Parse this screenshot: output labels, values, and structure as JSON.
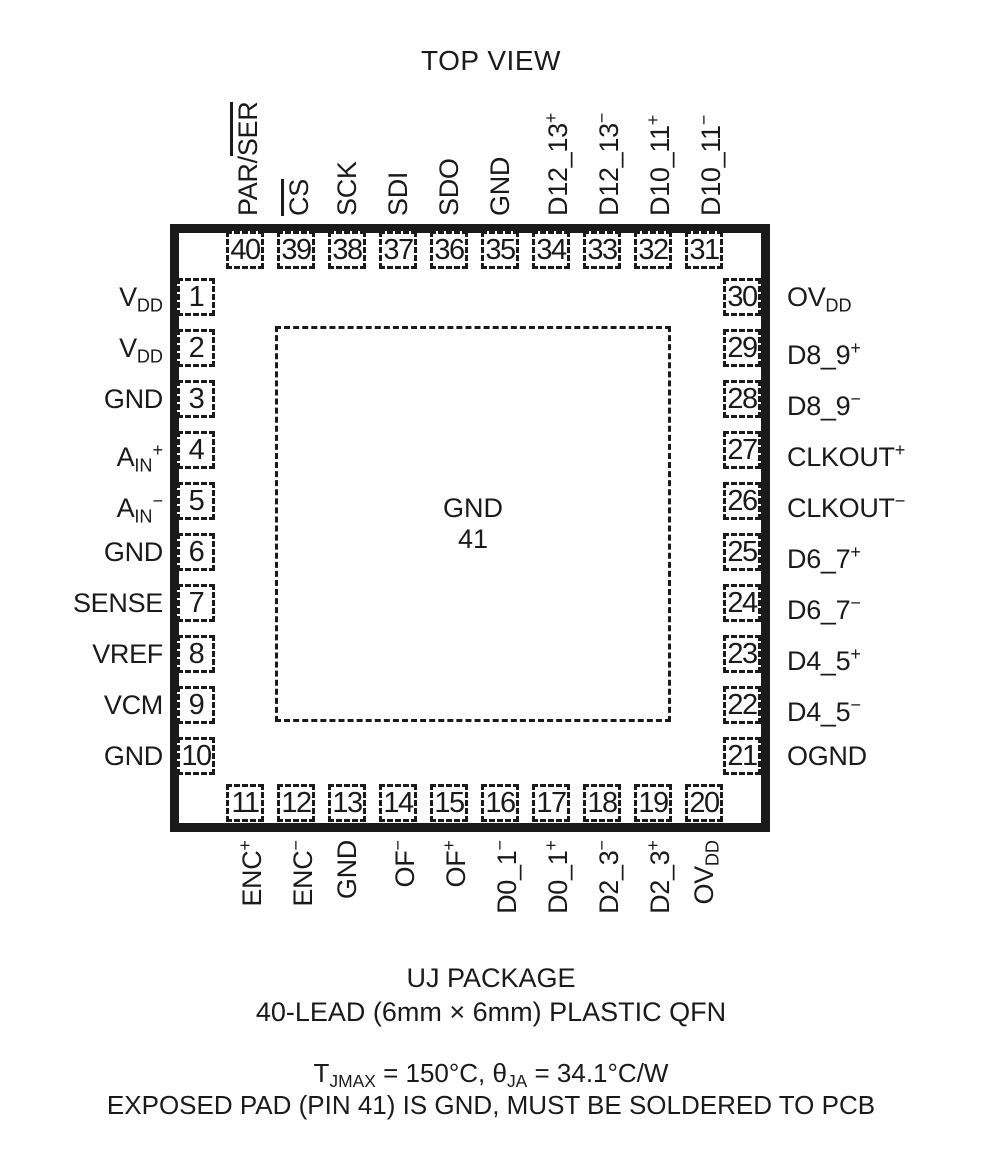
{
  "title": "TOP VIEW",
  "center_pad": {
    "label": "GND",
    "number": "41"
  },
  "pins": {
    "top": [
      {
        "num": "40",
        "label": [
          {
            "t": "PAR/"
          },
          {
            "t": "SER",
            "ov": true
          }
        ]
      },
      {
        "num": "39",
        "label": [
          {
            "t": "CS",
            "ov": true
          }
        ]
      },
      {
        "num": "38",
        "label": [
          {
            "t": "SCK"
          }
        ]
      },
      {
        "num": "37",
        "label": [
          {
            "t": "SDI"
          }
        ]
      },
      {
        "num": "36",
        "label": [
          {
            "t": "SDO"
          }
        ]
      },
      {
        "num": "35",
        "label": [
          {
            "t": "GND"
          }
        ]
      },
      {
        "num": "34",
        "label": [
          {
            "t": "D12_13"
          },
          {
            "t": "+",
            "sup": true
          }
        ]
      },
      {
        "num": "33",
        "label": [
          {
            "t": "D12_13"
          },
          {
            "t": "−",
            "sup": true
          }
        ]
      },
      {
        "num": "32",
        "label": [
          {
            "t": "D10_11"
          },
          {
            "t": "+",
            "sup": true
          }
        ]
      },
      {
        "num": "31",
        "label": [
          {
            "t": "D10_11"
          },
          {
            "t": "−",
            "sup": true
          }
        ]
      }
    ],
    "left": [
      {
        "num": "1",
        "label": [
          {
            "t": "V"
          },
          {
            "t": "DD",
            "sub": true
          }
        ]
      },
      {
        "num": "2",
        "label": [
          {
            "t": "V"
          },
          {
            "t": "DD",
            "sub": true
          }
        ]
      },
      {
        "num": "3",
        "label": [
          {
            "t": "GND"
          }
        ]
      },
      {
        "num": "4",
        "label": [
          {
            "t": "A"
          },
          {
            "t": "IN",
            "sub": true
          },
          {
            "t": "+",
            "sup": true
          }
        ]
      },
      {
        "num": "5",
        "label": [
          {
            "t": "A"
          },
          {
            "t": "IN",
            "sub": true
          },
          {
            "t": "−",
            "sup": true
          }
        ]
      },
      {
        "num": "6",
        "label": [
          {
            "t": "GND"
          }
        ]
      },
      {
        "num": "7",
        "label": [
          {
            "t": "SENSE"
          }
        ]
      },
      {
        "num": "8",
        "label": [
          {
            "t": "VREF"
          }
        ]
      },
      {
        "num": "9",
        "label": [
          {
            "t": "VCM"
          }
        ]
      },
      {
        "num": "10",
        "label": [
          {
            "t": "GND"
          }
        ]
      }
    ],
    "right": [
      {
        "num": "30",
        "label": [
          {
            "t": "OV"
          },
          {
            "t": "DD",
            "sub": true
          }
        ]
      },
      {
        "num": "29",
        "label": [
          {
            "t": "D8_9"
          },
          {
            "t": "+",
            "sup": true
          }
        ]
      },
      {
        "num": "28",
        "label": [
          {
            "t": "D8_9"
          },
          {
            "t": "−",
            "sup": true
          }
        ]
      },
      {
        "num": "27",
        "label": [
          {
            "t": "CLKOUT"
          },
          {
            "t": "+",
            "sup": true
          }
        ]
      },
      {
        "num": "26",
        "label": [
          {
            "t": "CLKOUT"
          },
          {
            "t": "−",
            "sup": true
          }
        ]
      },
      {
        "num": "25",
        "label": [
          {
            "t": "D6_7"
          },
          {
            "t": "+",
            "sup": true
          }
        ]
      },
      {
        "num": "24",
        "label": [
          {
            "t": "D6_7"
          },
          {
            "t": "−",
            "sup": true
          }
        ]
      },
      {
        "num": "23",
        "label": [
          {
            "t": "D4_5"
          },
          {
            "t": "+",
            "sup": true
          }
        ]
      },
      {
        "num": "22",
        "label": [
          {
            "t": "D4_5"
          },
          {
            "t": "−",
            "sup": true
          }
        ]
      },
      {
        "num": "21",
        "label": [
          {
            "t": "OGND"
          }
        ]
      }
    ],
    "bottom": [
      {
        "num": "11",
        "label": [
          {
            "t": "ENC"
          },
          {
            "t": "+",
            "sup": true
          }
        ]
      },
      {
        "num": "12",
        "label": [
          {
            "t": "ENC"
          },
          {
            "t": "−",
            "sup": true
          }
        ]
      },
      {
        "num": "13",
        "label": [
          {
            "t": "GND"
          }
        ]
      },
      {
        "num": "14",
        "label": [
          {
            "t": "OF"
          },
          {
            "t": "−",
            "sup": true
          }
        ]
      },
      {
        "num": "15",
        "label": [
          {
            "t": "OF"
          },
          {
            "t": "+",
            "sup": true
          }
        ]
      },
      {
        "num": "16",
        "label": [
          {
            "t": "D0_1"
          },
          {
            "t": "−",
            "sup": true
          }
        ]
      },
      {
        "num": "17",
        "label": [
          {
            "t": "D0_1"
          },
          {
            "t": "+",
            "sup": true
          }
        ]
      },
      {
        "num": "18",
        "label": [
          {
            "t": "D2_3"
          },
          {
            "t": "−",
            "sup": true
          }
        ]
      },
      {
        "num": "19",
        "label": [
          {
            "t": "D2_3"
          },
          {
            "t": "+",
            "sup": true
          }
        ]
      },
      {
        "num": "20",
        "label": [
          {
            "t": "OV"
          },
          {
            "t": "DD",
            "sub": true
          }
        ]
      }
    ]
  },
  "footer": {
    "line1": "UJ PACKAGE",
    "line2": "40-LEAD (6mm × 6mm) PLASTIC QFN",
    "line3": [
      {
        "t": "T"
      },
      {
        "t": "JMAX",
        "sub": true
      },
      {
        "t": " = 150°C, θ"
      },
      {
        "t": "JA",
        "sub": true
      },
      {
        "t": " = 34.1°C/W"
      }
    ],
    "line4": "EXPOSED PAD (PIN 41) IS GND, MUST BE SOLDERED TO PCB"
  },
  "colors": {
    "ink": "#1a1a1a",
    "background": "#ffffff"
  }
}
